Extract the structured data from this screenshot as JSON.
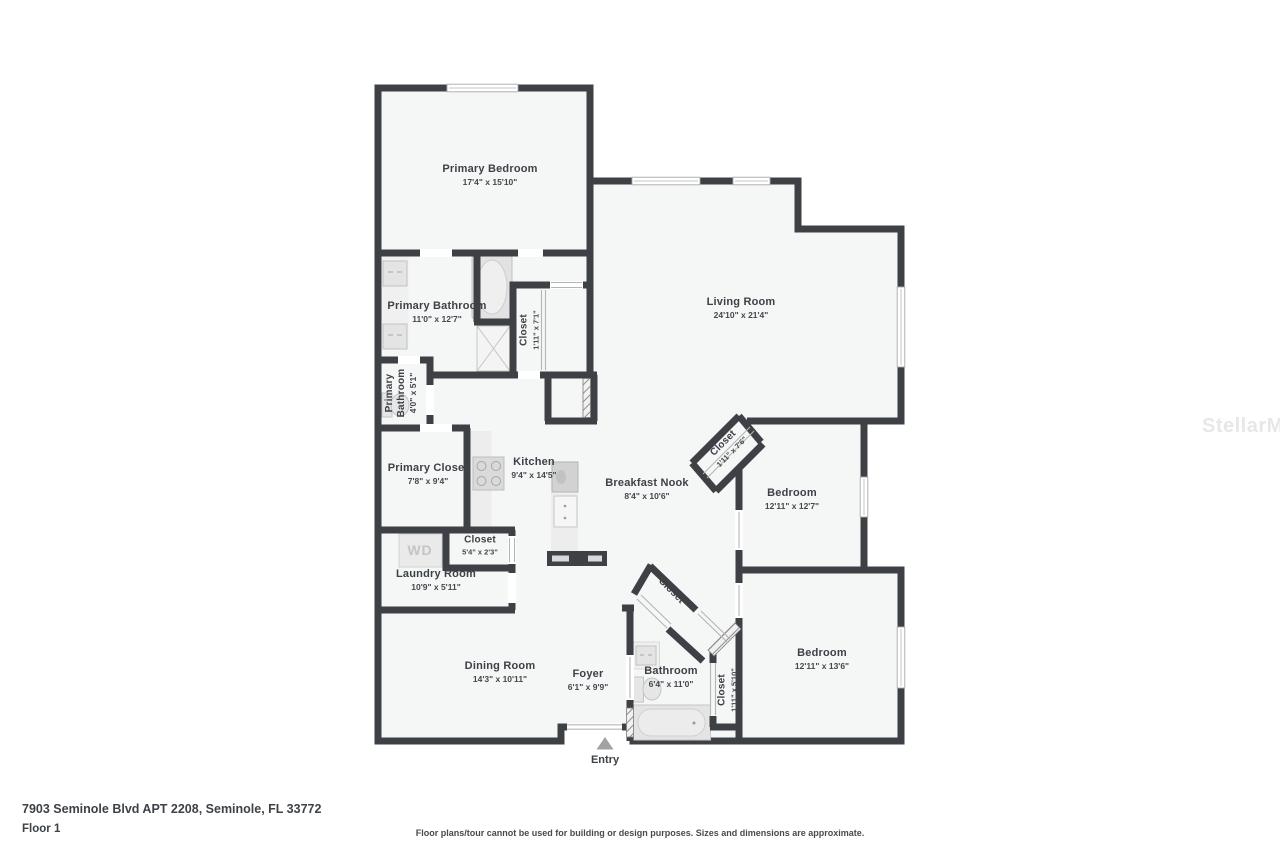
{
  "page": {
    "address": "7903 Seminole Blvd APT 2208, Seminole, FL 33772",
    "floor_label": "Floor 1",
    "disclaimer": "Floor plans/tour cannot be used for building or design purposes. Sizes and dimensions are approximate.",
    "watermark": "StellarMLS"
  },
  "floorplan": {
    "entry_label": "Entry",
    "washer_dryer_label": "WD",
    "rooms": [
      {
        "id": "primary-bedroom",
        "name": "Primary Bedroom",
        "dims": "17'4\" x 15'10\""
      },
      {
        "id": "living-room",
        "name": "Living Room",
        "dims": "24'10\" x 21'4\""
      },
      {
        "id": "primary-bathroom",
        "name": "Primary Bathroom",
        "dims": "11'0\" x 12'7\""
      },
      {
        "id": "closet-hall",
        "name": "Closet",
        "dims": "1'11\" x 7'1\""
      },
      {
        "id": "primary-bathroom-wc",
        "name": "Primary Bathroom",
        "dims": "4'0\" x 5'1\""
      },
      {
        "id": "primary-closet",
        "name": "Primary Closet",
        "dims": "7'8\" x 9'4\""
      },
      {
        "id": "kitchen",
        "name": "Kitchen",
        "dims": "9'4\" x 14'5\""
      },
      {
        "id": "breakfast-nook",
        "name": "Breakfast Nook",
        "dims": "8'4\" x 10'6\""
      },
      {
        "id": "closet-bedroom-1",
        "name": "Closet",
        "dims": "1'11\" x 7'6\""
      },
      {
        "id": "bedroom-1",
        "name": "Bedroom",
        "dims": "12'11\" x 12'7\""
      },
      {
        "id": "closet-laundry",
        "name": "Closet",
        "dims": "5'4\" x 2'3\""
      },
      {
        "id": "laundry-room",
        "name": "Laundry Room",
        "dims": "10'9\" x 5'11\""
      },
      {
        "id": "dining-room",
        "name": "Dining Room",
        "dims": "14'3\" x 10'11\""
      },
      {
        "id": "foyer",
        "name": "Foyer",
        "dims": "6'1\" x 9'9\""
      },
      {
        "id": "bathroom",
        "name": "Bathroom",
        "dims": "6'4\" x 11'0\""
      },
      {
        "id": "closet-bathroom-hall",
        "name": "Closet",
        "dims": "1'11\" x 5'10\""
      },
      {
        "id": "bedroom-2",
        "name": "Bedroom",
        "dims": "12'11\" x 13'6\""
      },
      {
        "id": "closet-foyer",
        "name": "Closet",
        "dims": ""
      }
    ]
  },
  "colors": {
    "wall": "#3d4045",
    "room_fill": "#f5f6f6",
    "label_text": "#3d4247",
    "fixture_fill": "#e6e6e6",
    "watermark_gray": "#e7e7e7"
  }
}
